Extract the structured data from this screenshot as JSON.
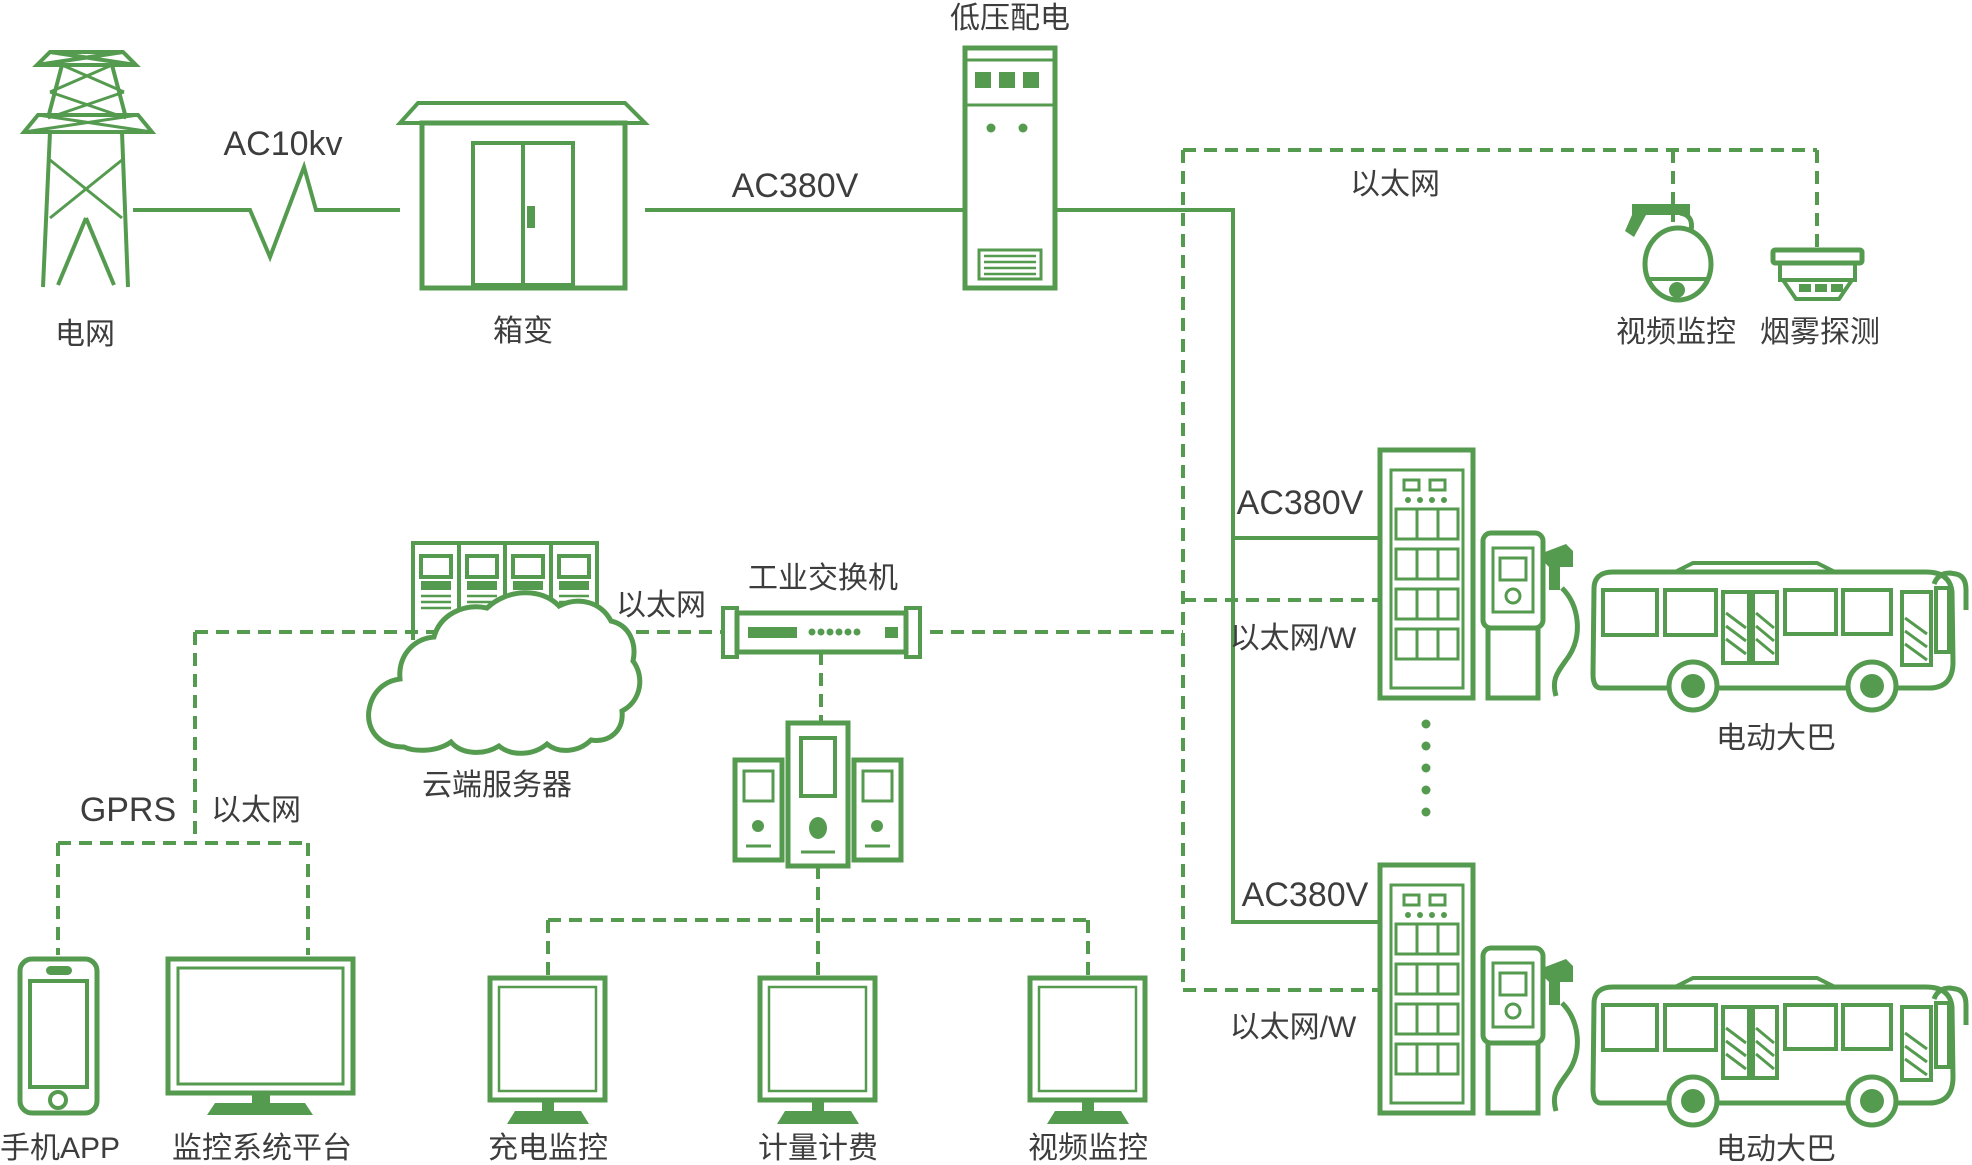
{
  "colors": {
    "line_green": "#559b4f",
    "label_dark": "#3d3d3d"
  },
  "nodes": {
    "power_grid": {
      "label": "电网"
    },
    "box_transformer": {
      "label": "箱变"
    },
    "lv_distribution": {
      "label": "低压配电"
    },
    "video_surveillance": {
      "label": "视频监控"
    },
    "smoke_detection": {
      "label": "烟雾探测"
    },
    "cloud_server": {
      "label": "云端服务器"
    },
    "industrial_switch": {
      "label": "工业交换机"
    },
    "mobile_app": {
      "label": "手机APP"
    },
    "monitoring_platform": {
      "label": "监控系统平台"
    },
    "charging_monitor": {
      "label": "充电监控"
    },
    "metering_billing": {
      "label": "计量计费"
    },
    "video_monitor": {
      "label": "视频监控"
    },
    "electric_bus1": {
      "label": "电动大巴"
    },
    "electric_bus2": {
      "label": "电动大巴"
    }
  },
  "links": {
    "ac10kv": {
      "label": "AC10kv"
    },
    "ac380v": {
      "label": "AC380V"
    },
    "ethernet_top": {
      "label": "以太网"
    },
    "ethernet_cloud": {
      "label": "以太网"
    },
    "gprs": {
      "label": "GPRS"
    },
    "ethernet_left": {
      "label": "以太网"
    },
    "ac380v_row1": {
      "label": "AC380V"
    },
    "ethernet_w_row1": {
      "label": "以太网/W"
    },
    "ac380v_row2": {
      "label": "AC380V"
    },
    "ethernet_w_row2": {
      "label": "以太网/W"
    }
  }
}
